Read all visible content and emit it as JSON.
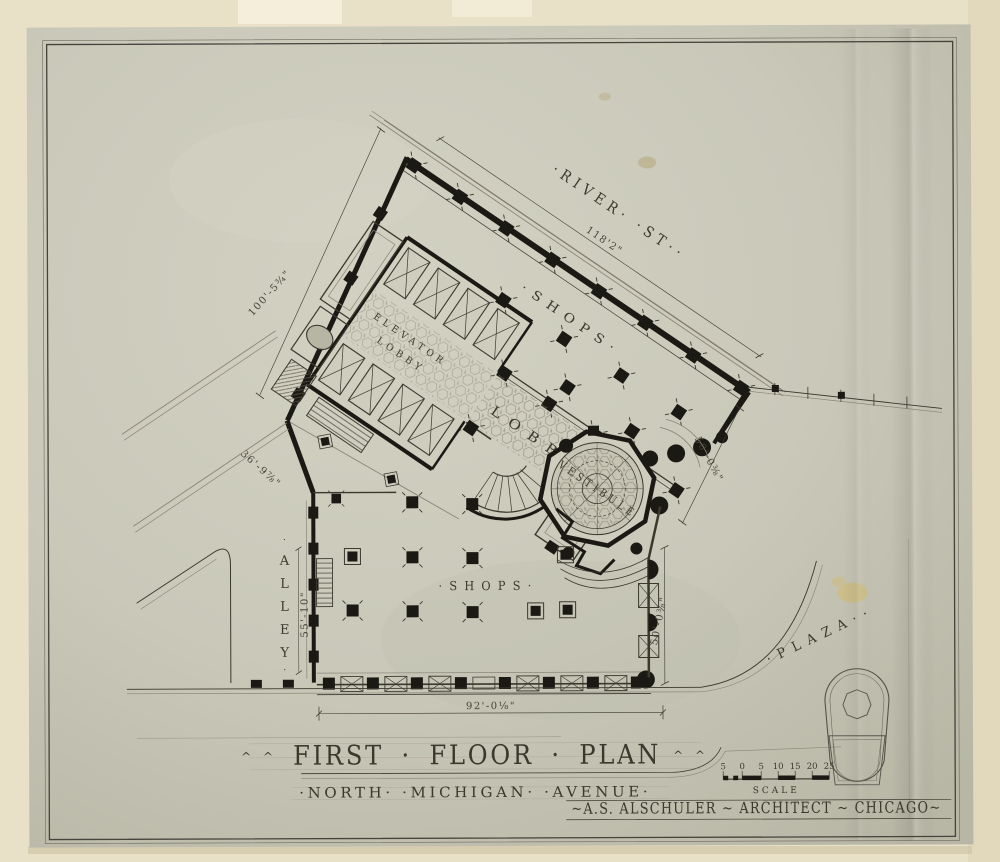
{
  "colors": {
    "mat": "#e9e0c8",
    "sheet": "#c9c8b9",
    "ink": "#3b382e",
    "wall_black": "#1b1914",
    "stain_yellow": "#d4b96a"
  },
  "title_block": {
    "title": "FIRST · FLOOR · PLAN",
    "ornament_left": "^  ^",
    "ornament_right": "^  ^",
    "street_line": "·NORTH·  ·MICHIGAN·  ·AVENUE·",
    "architect": "~A.S. ALSCHULER ~ ARCHITECT ~ CHICAGO~"
  },
  "labels": {
    "shops_upper": "·SHOPS·",
    "shops_lower": "·SHOPS·",
    "lobby": "LOBBY",
    "elevator_line1": "ELEVATOR",
    "elevator_line2": "LOBBY",
    "vestibule": "VESTIBULE"
  },
  "streets": {
    "river": "·RIVER·  ·ST··",
    "plaza": "·PLAZA··",
    "alley_letters": [
      "·",
      "A",
      "L",
      "L",
      "E",
      "Y",
      "·"
    ]
  },
  "dimensions": {
    "river_frontage": "118'2\"",
    "northwest": "100'-5¾\"",
    "southwest_diagonal": "36'-9⅞\"",
    "alley": "55'-10\"",
    "east_diagonal": "50'-0⅜\"",
    "east_vertical": "50'-0⅜\"",
    "michigan_frontage": "92'-0⅛\""
  },
  "scale_bar": {
    "marks": [
      "5",
      "0",
      "5",
      "10",
      "15",
      "20",
      "25"
    ],
    "label": "SCALE"
  }
}
